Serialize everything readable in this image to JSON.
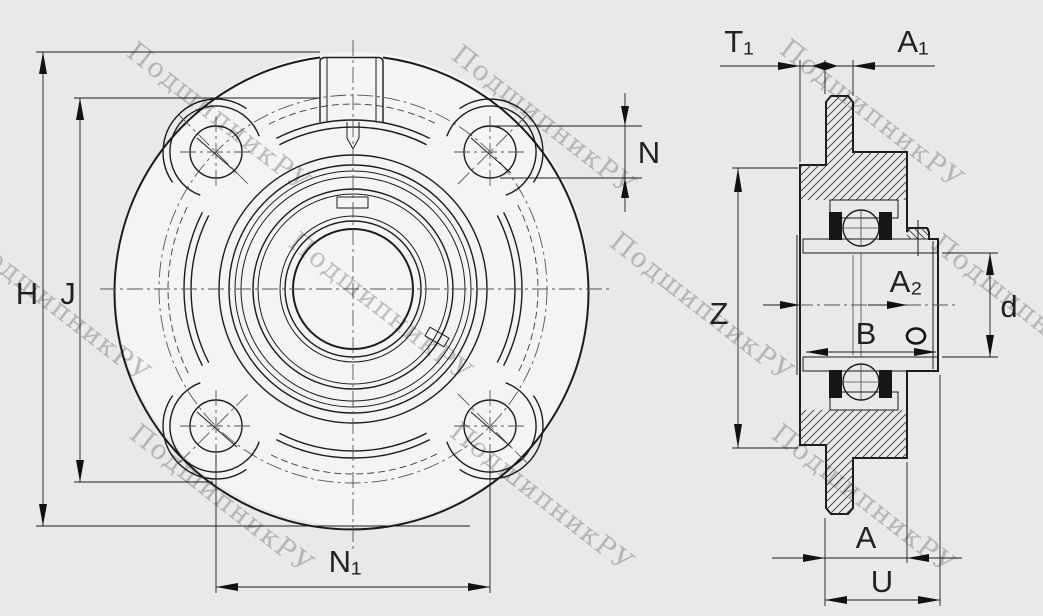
{
  "watermark": {
    "text": "ПодшипникРУ",
    "color": "#b9b9b9",
    "angle_deg": 38,
    "font_size": 27
  },
  "colors": {
    "background": "#e9e9e9",
    "paper_fill": "#f4f4f4",
    "line": "#1c1c1c"
  },
  "drawing_type": "flanged bearing unit, front view and sectional side view",
  "front_view": {
    "labels": {
      "h": "H",
      "j": "J",
      "n": "N",
      "n1": "N₁"
    }
  },
  "side_view": {
    "labels": {
      "t1": "T₁",
      "a1": "A₁",
      "z": "Z",
      "a2": "A₂",
      "b": "B",
      "d": "d",
      "a": "A",
      "u": "U"
    }
  }
}
